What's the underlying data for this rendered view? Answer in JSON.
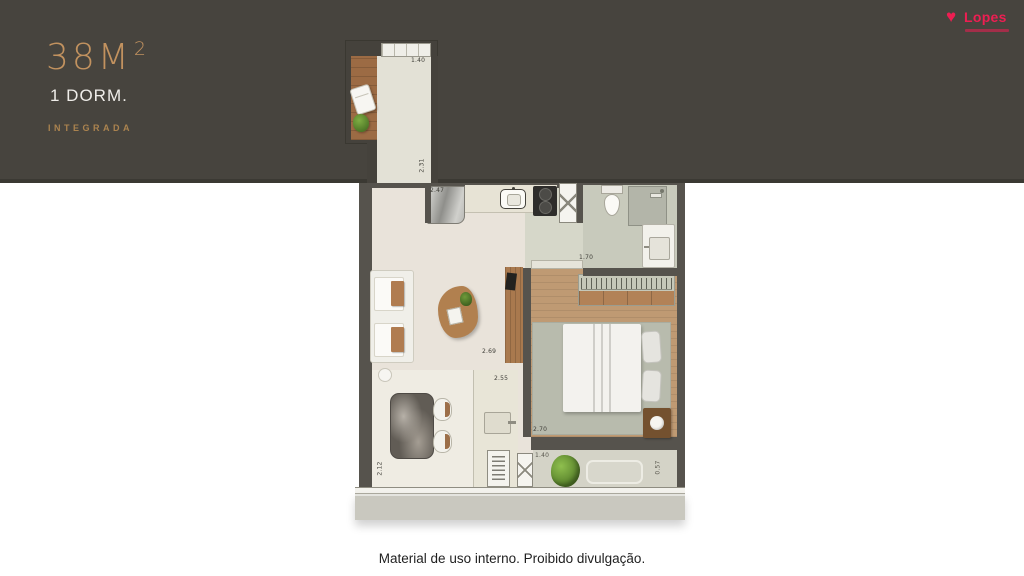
{
  "header": {
    "area_value": "38M",
    "area_superscript": "2",
    "bedrooms": "1 DORM.",
    "variant": "INTEGRADA"
  },
  "logo": {
    "brand": "Lopes"
  },
  "floorplan": {
    "dimensions": {
      "balcony_window": "1.40",
      "corridor": "2.31",
      "kitchen": "2.47",
      "bathroom": "1.70",
      "living_width": "2.69",
      "living_depth": "2.55",
      "dining": "2.12",
      "bedroom": "2.70",
      "ledge_width": "1.40",
      "ledge_depth": "0.57"
    }
  },
  "footer": {
    "disclaimer": "Material de uso interno. Proibido divulgação."
  },
  "colors": {
    "band": "#47443e",
    "gold": "#c2925f",
    "logo_red": "#ee1e52",
    "wall": "#56534d",
    "wood": "#b07c50"
  }
}
